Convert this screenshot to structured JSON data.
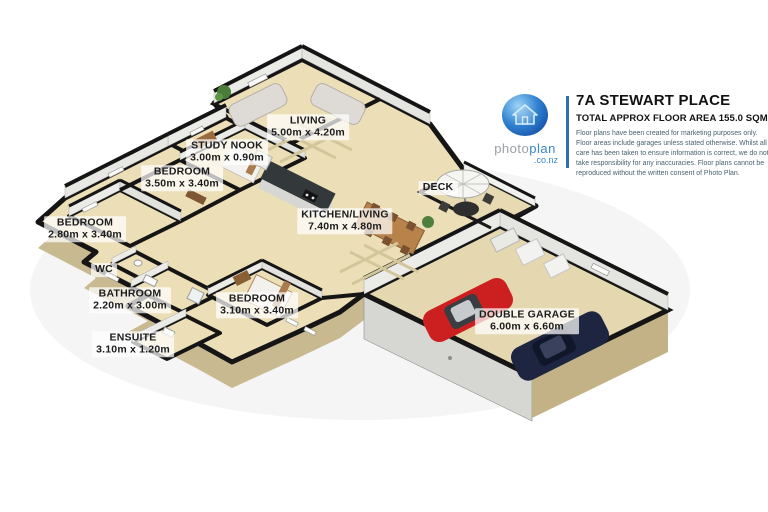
{
  "header": {
    "title": "7A STEWART PLACE",
    "subtitle": "TOTAL APPROX FLOOR AREA 155.0 SQM",
    "disclaimer": "Floor plans have been created for marketing purposes only. Floor areas include garages unless stated otherwise. Whilst all care has been taken to ensure information is correct, we do not take responsibility for any inaccuracies. Floor plans cannot be reproduced without the written consent of Photo Plan.",
    "logo": {
      "brand_photo": "photo",
      "brand_plan": "plan",
      "brand_suffix": ".co.nz",
      "icon": "house-icon"
    }
  },
  "rooms": [
    {
      "name": "LIVING",
      "dims": "5.00m x 4.20m"
    },
    {
      "name": "STUDY NOOK",
      "dims": "3.00m x 0.90m"
    },
    {
      "name": "BEDROOM",
      "dims": "3.50m x 3.40m"
    },
    {
      "name": "BEDROOM",
      "dims": "2.80m x 3.40m"
    },
    {
      "name": "WC",
      "dims": ""
    },
    {
      "name": "BATHROOM",
      "dims": "2.20m x 3.00m"
    },
    {
      "name": "ENSUITE",
      "dims": "3.10m x 1.20m"
    },
    {
      "name": "BEDROOM",
      "dims": "3.10m x 3.40m"
    },
    {
      "name": "KITCHEN/LIVING",
      "dims": "7.40m x 4.80m"
    },
    {
      "name": "DECK",
      "dims": ""
    },
    {
      "name": "DOUBLE GARAGE",
      "dims": "6.00m x 6.60m"
    }
  ],
  "colors": {
    "floor": "#ecdfb8",
    "exterior_wall": "#c9b990",
    "wall_line": "#151515",
    "wall_face_white": "#ebebe8",
    "brand_blue": "#2f6fb0",
    "brand_gray": "#9aa0a6",
    "car_red": "#cc1f1f",
    "car_navy": "#1d2540"
  }
}
